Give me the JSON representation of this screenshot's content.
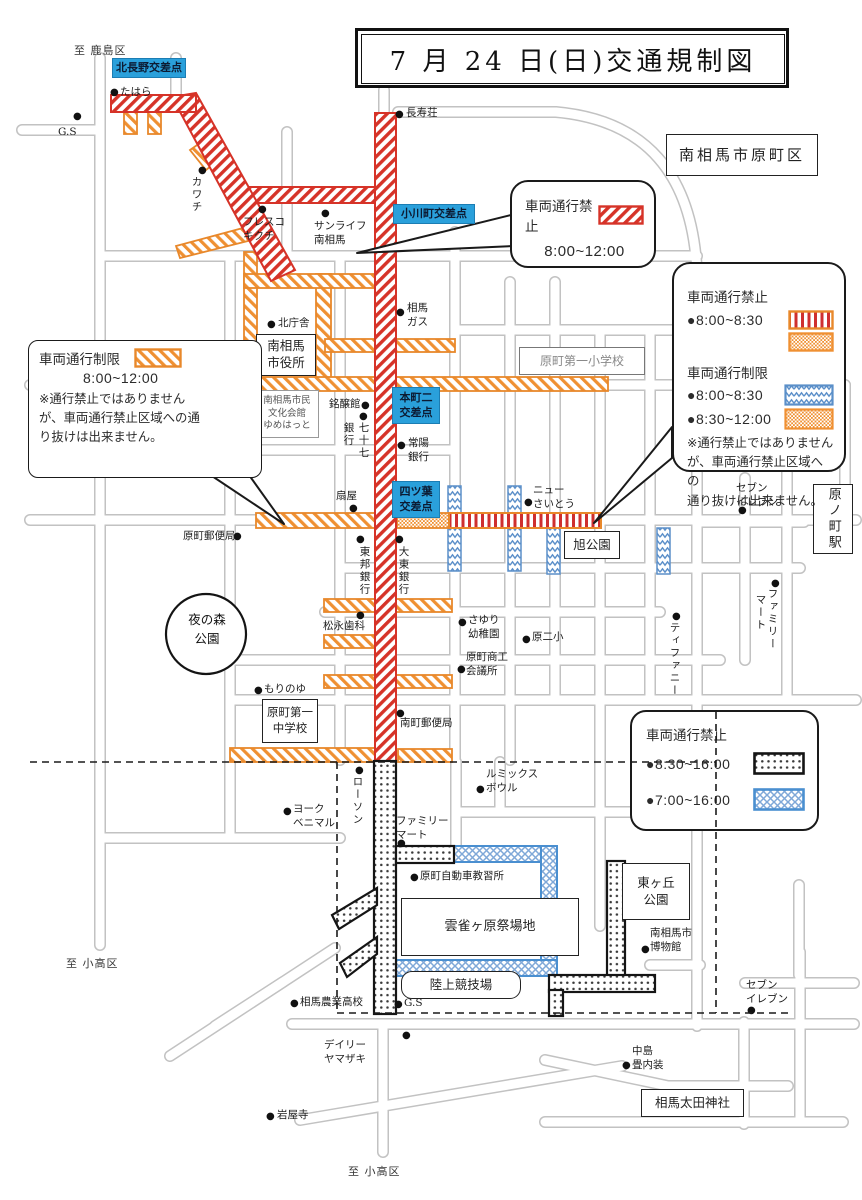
{
  "title": {
    "text": "7 月 24 日(日)交通規制図"
  },
  "colors": {
    "prohibit_red": "#d63328",
    "prohibit_red_stripe": "#cf2f2f",
    "restrict_orange": "#e8882b",
    "restrict_blue": "#5b8fc9",
    "crosshatch_blue": "#4a8fd0",
    "prohibit_black": "#151515",
    "intersection_label_blue": "#2aa0db",
    "road_casing_gray": "#c2c2c2"
  },
  "bubble_top": {
    "label": "車両通行禁止",
    "time": "8:00~12:00",
    "swatch": "red-diagonal-hatch"
  },
  "bubble_left": {
    "label": "車両通行制限",
    "time": "8:00~12:00",
    "swatch": "orange-diagonal-hatch",
    "note": "※通行禁止ではありません\nが、車両通行禁止区域への通\nり抜けは出来ません。"
  },
  "legend_right": {
    "prohibit_title": "車両通行禁止",
    "prohibit_time": "●8:00~8:30",
    "prohibit_swatches": [
      "red-vertical-stripes",
      "orange-dots"
    ],
    "restrict_title": "車両通行制限",
    "restrict_time1": "●8:00~8:30",
    "restrict_swatch1": "blue-zigzag",
    "restrict_time2": "●8:30~12:00",
    "restrict_swatch2": "orange-dots",
    "note": "※通行禁止ではありません\nが、車両通行禁止区域への\n通り抜けは出来ません。"
  },
  "legend_bottom": {
    "title": "車両通行禁止",
    "time1": "●8:30~16:00",
    "swatch1": "black-dots",
    "time2": "●7:00~16:00",
    "swatch2": "blue-crosshatch"
  },
  "intersections": [
    {
      "label": "北長野交差点",
      "x": 112,
      "y": 58,
      "w": 74,
      "h": 20
    },
    {
      "label": "小川町交差点",
      "x": 393,
      "y": 204,
      "w": 82,
      "h": 20
    },
    {
      "label": "本町二\n交差点",
      "x": 392,
      "y": 387,
      "w": 48,
      "h": 37
    },
    {
      "label": "四ツ葉\n交差点",
      "x": 392,
      "y": 481,
      "w": 48,
      "h": 37
    }
  ],
  "boxes": [
    {
      "label": "南相馬\n市役所",
      "x": 256,
      "y": 334,
      "w": 60,
      "h": 42,
      "fs": 12.5
    },
    {
      "label": "南相馬市民\n文化会館\nゆめはっと",
      "x": 255,
      "y": 390,
      "w": 64,
      "h": 48,
      "fs": 9.5,
      "kind": "gray"
    },
    {
      "label": "原町第一小学校",
      "x": 519,
      "y": 347,
      "w": 126,
      "h": 28,
      "fs": 12,
      "kind": "gray2"
    },
    {
      "label": "旭公園",
      "x": 564,
      "y": 531,
      "w": 56,
      "h": 28,
      "fs": 12.5
    },
    {
      "label": "原町第一\n中学校",
      "x": 262,
      "y": 699,
      "w": 56,
      "h": 44,
      "fs": 11.5
    },
    {
      "label": "原ノ町駅",
      "x": 813,
      "y": 484,
      "w": 40,
      "h": 70,
      "fs": 13,
      "kind": "v"
    },
    {
      "label": "東ヶ丘\n公園",
      "x": 622,
      "y": 863,
      "w": 68,
      "h": 57,
      "fs": 12.5
    },
    {
      "label": "雲雀ヶ原祭場地",
      "x": 401,
      "y": 898,
      "w": 178,
      "h": 58,
      "fs": 13
    },
    {
      "label": "陸上競技場",
      "x": 401,
      "y": 971,
      "w": 120,
      "h": 28,
      "fs": 12.5,
      "kind": "round"
    },
    {
      "label": "相馬太田神社",
      "x": 641,
      "y": 1089,
      "w": 103,
      "h": 28,
      "fs": 12.5
    },
    {
      "label": "南相馬市原町区",
      "x": 666,
      "y": 134,
      "w": 152,
      "h": 42,
      "fs": 15,
      "kind": "region"
    }
  ],
  "park": {
    "label": "夜の森\n公園",
    "x": 178,
    "y": 611,
    "w": 58
  },
  "area_labels": [
    {
      "t": "至 鹿島区",
      "x": 74,
      "y": 42
    },
    {
      "t": "至 小高区",
      "x": 66,
      "y": 955
    },
    {
      "t": "至 小高区",
      "x": 348,
      "y": 1163
    }
  ],
  "pois": [
    {
      "t": "たはら",
      "x": 120,
      "y": 86,
      "dot": [
        110,
        88
      ]
    },
    {
      "t": "G.S",
      "x": 58,
      "y": 126,
      "dot": [
        73,
        112
      ]
    },
    {
      "t": "カワチ",
      "x": 190,
      "y": 176,
      "v": 1,
      "dot": [
        198,
        166
      ]
    },
    {
      "t": "フレスコ\nキクチ",
      "x": 243,
      "y": 216,
      "dot": [
        258,
        205
      ]
    },
    {
      "t": "サンライフ\n南相馬",
      "x": 314,
      "y": 220,
      "dot": [
        321,
        209
      ]
    },
    {
      "t": "長寿荘",
      "x": 406,
      "y": 107,
      "dot": [
        395,
        110
      ]
    },
    {
      "t": "北庁舎",
      "x": 278,
      "y": 317,
      "dot": [
        267,
        320
      ]
    },
    {
      "t": "相馬\nガス",
      "x": 407,
      "y": 302,
      "dot": [
        396,
        308
      ]
    },
    {
      "t": "銘醸館",
      "x": 329,
      "y": 398,
      "dot": [
        361,
        401
      ]
    },
    {
      "t": "銀行",
      "x": 342,
      "y": 422,
      "v": 1,
      "dot": [
        359,
        412
      ]
    },
    {
      "t": "七十七",
      "x": 357,
      "y": 422,
      "v": 1
    },
    {
      "t": "常陽\n銀行",
      "x": 408,
      "y": 437,
      "dot": [
        397,
        441
      ]
    },
    {
      "t": "扇屋",
      "x": 336,
      "y": 490,
      "dot": [
        349,
        504
      ]
    },
    {
      "t": "東邦銀行",
      "x": 358,
      "y": 546,
      "v": 1,
      "dot": [
        356,
        535
      ]
    },
    {
      "t": "大東銀行",
      "x": 397,
      "y": 546,
      "v": 1,
      "dot": [
        395,
        535
      ]
    },
    {
      "t": "ニュー\nさいとう",
      "x": 533,
      "y": 484,
      "dot": [
        524,
        498
      ]
    },
    {
      "t": "セブン\nイレブン",
      "x": 736,
      "y": 482,
      "dot": [
        738,
        506
      ]
    },
    {
      "t": "ファミリー",
      "x": 766,
      "y": 588,
      "v": 1,
      "dot": [
        771,
        579
      ]
    },
    {
      "t": "マート",
      "x": 754,
      "y": 594,
      "v": 1
    },
    {
      "t": "ティファニー",
      "x": 668,
      "y": 622,
      "v": 1,
      "dot": [
        672,
        612
      ]
    },
    {
      "t": "原町郵便局",
      "x": 183,
      "y": 530,
      "dot": [
        233,
        532
      ]
    },
    {
      "t": "松永歯科",
      "x": 323,
      "y": 620,
      "dot": [
        356,
        611
      ]
    },
    {
      "t": "さゆり\n幼稚園",
      "x": 468,
      "y": 614,
      "dot": [
        458,
        618
      ]
    },
    {
      "t": "原二小",
      "x": 532,
      "y": 631,
      "dot": [
        522,
        635
      ]
    },
    {
      "t": "原町商工\n会議所",
      "x": 466,
      "y": 651,
      "dot": [
        457,
        665
      ]
    },
    {
      "t": "南町郵便局",
      "x": 400,
      "y": 717,
      "dot": [
        396,
        709
      ]
    },
    {
      "t": "もりのゆ",
      "x": 264,
      "y": 683,
      "dot": [
        254,
        686
      ]
    },
    {
      "t": "ルミックス\nボウル",
      "x": 486,
      "y": 768,
      "dot": [
        476,
        785
      ]
    },
    {
      "t": "ヨーク\nベニマル",
      "x": 293,
      "y": 803,
      "dot": [
        283,
        807
      ]
    },
    {
      "t": "ローソン",
      "x": 351,
      "y": 776,
      "v": 1,
      "dot": [
        355,
        766
      ]
    },
    {
      "t": "ファミリー\nマート",
      "x": 396,
      "y": 815,
      "dot": [
        397,
        839
      ]
    },
    {
      "t": "原町自動車教習所",
      "x": 420,
      "y": 870,
      "dot": [
        410,
        873
      ]
    },
    {
      "t": "南相馬市\n博物館",
      "x": 650,
      "y": 927,
      "dot": [
        641,
        945
      ]
    },
    {
      "t": "セブン\nイレブン",
      "x": 746,
      "y": 979,
      "dot": [
        747,
        1006
      ]
    },
    {
      "t": "相馬農業高校",
      "x": 300,
      "y": 996,
      "dot": [
        290,
        999
      ]
    },
    {
      "t": "デイリー\nヤマザキ",
      "x": 324,
      "y": 1039,
      "dot": [
        402,
        1031
      ]
    },
    {
      "t": "岩屋寺",
      "x": 277,
      "y": 1109,
      "dot": [
        266,
        1112
      ]
    },
    {
      "t": "中島\n畳内装",
      "x": 632,
      "y": 1045,
      "dot": [
        622,
        1061
      ]
    },
    {
      "t": "G.S",
      "x": 404,
      "y": 997,
      "dot": [
        394,
        1000
      ]
    }
  ]
}
